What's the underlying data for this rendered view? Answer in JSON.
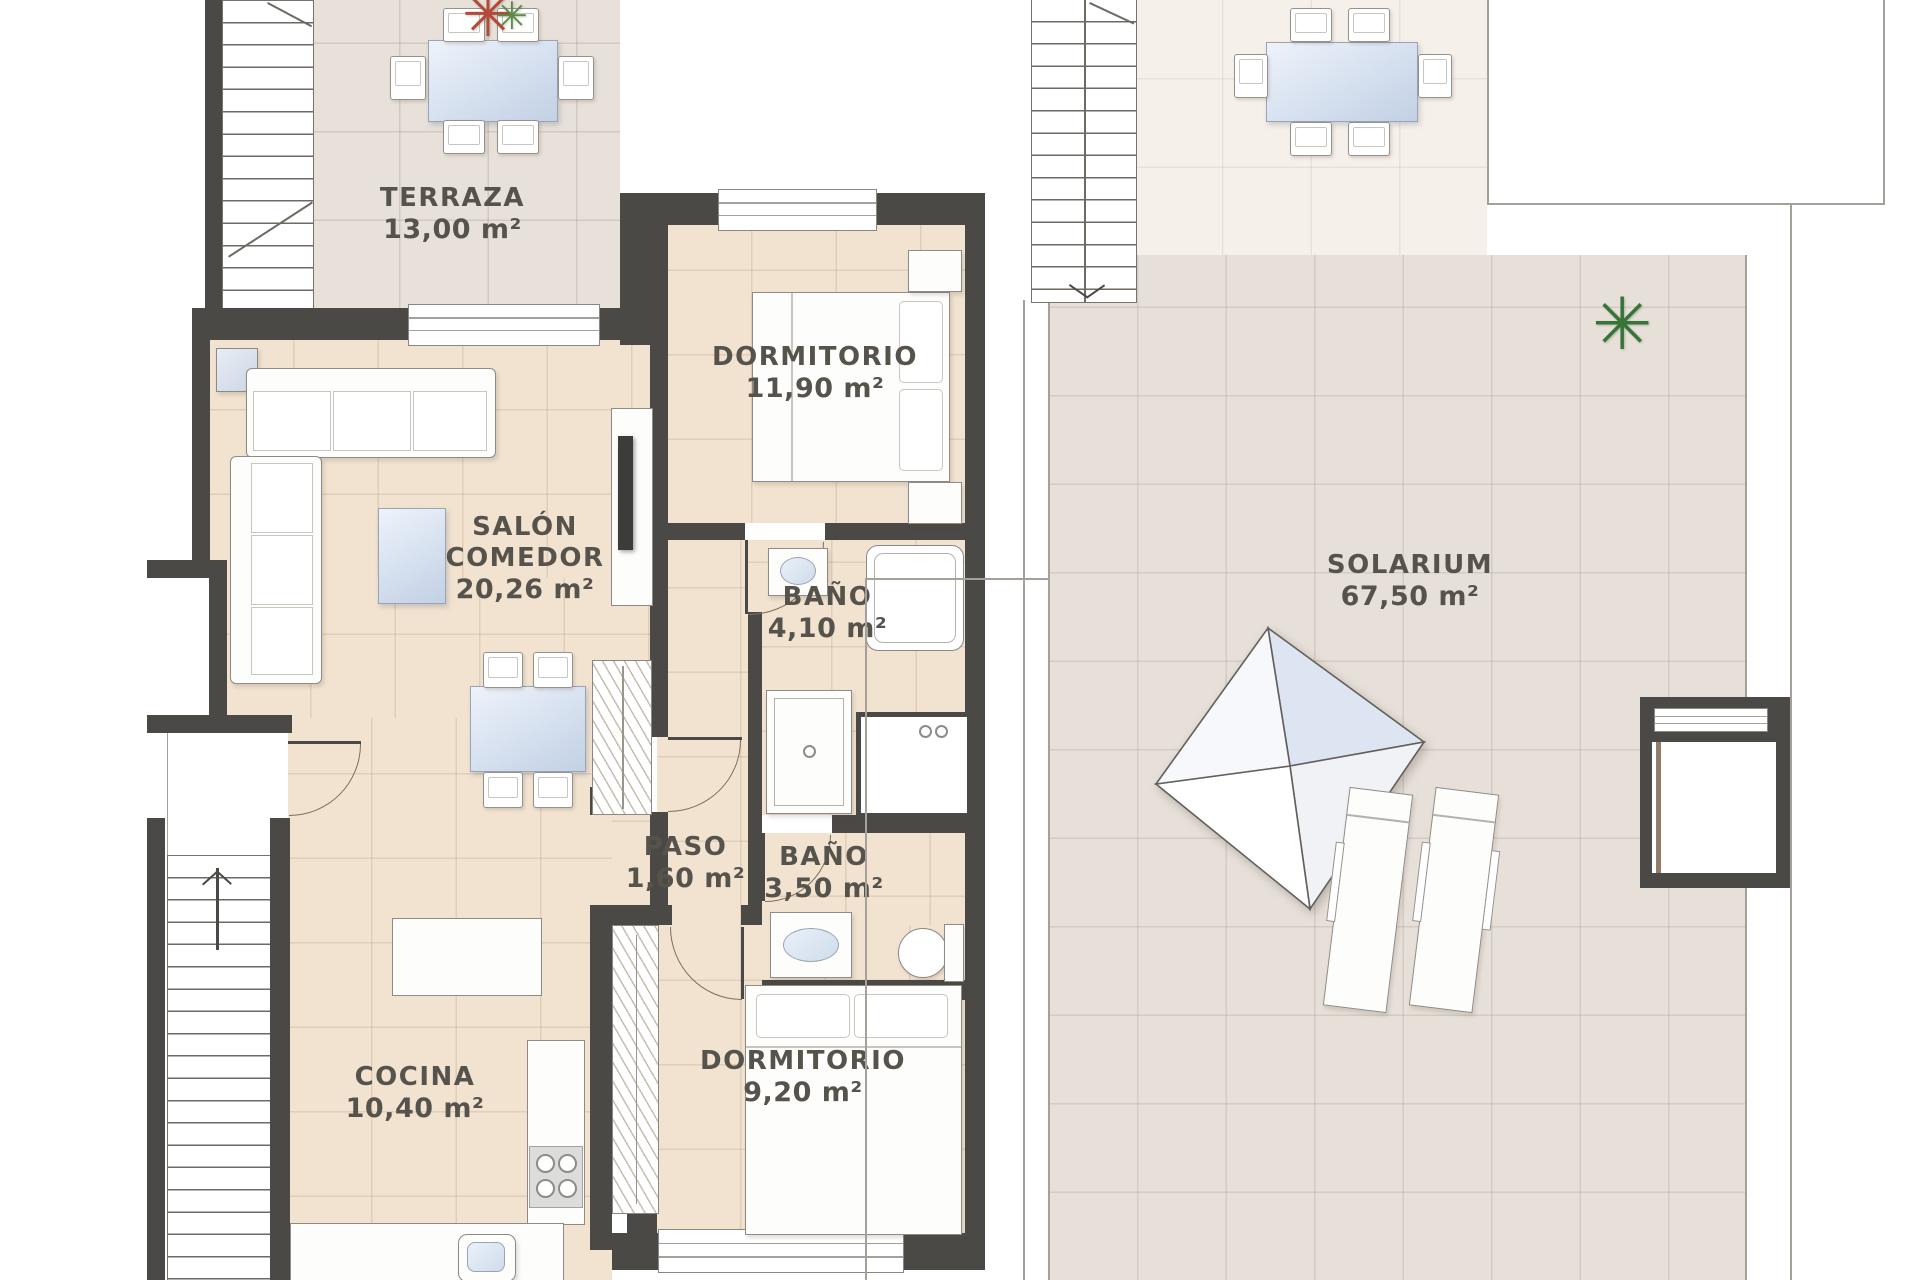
{
  "plans": {
    "apartment": {
      "rooms": {
        "terraza": {
          "name": "TERRAZA",
          "area": "13,00 m²"
        },
        "salon": {
          "name": "SALÓN COMEDOR",
          "area": "20,26 m²"
        },
        "dormitorio1": {
          "name": "DORMITORIO",
          "area": "11,90 m²"
        },
        "bano1": {
          "name": "BAÑO",
          "area": "4,10 m²"
        },
        "paso": {
          "name": "PASO",
          "area": "1,60 m²"
        },
        "bano2": {
          "name": "BAÑO",
          "area": "3,50 m²"
        },
        "cocina": {
          "name": "COCINA",
          "area": "10,40 m²"
        },
        "dormitorio2": {
          "name": "DORMITORIO",
          "area": "9,20 m²"
        }
      }
    },
    "roof": {
      "rooms": {
        "solarium": {
          "name": "SOLARIUM",
          "area": "67,50 m²"
        }
      }
    }
  },
  "icons": {
    "green_plant": "✳",
    "red_plant": "✳"
  },
  "colors": {
    "wall": "#4b4946",
    "floor_interior": "#f2e3d1",
    "floor_terrace": "#e8e1da",
    "floor_roof": "#f6f0ea",
    "glass": "#d9e3f0",
    "text": "#56534d"
  }
}
